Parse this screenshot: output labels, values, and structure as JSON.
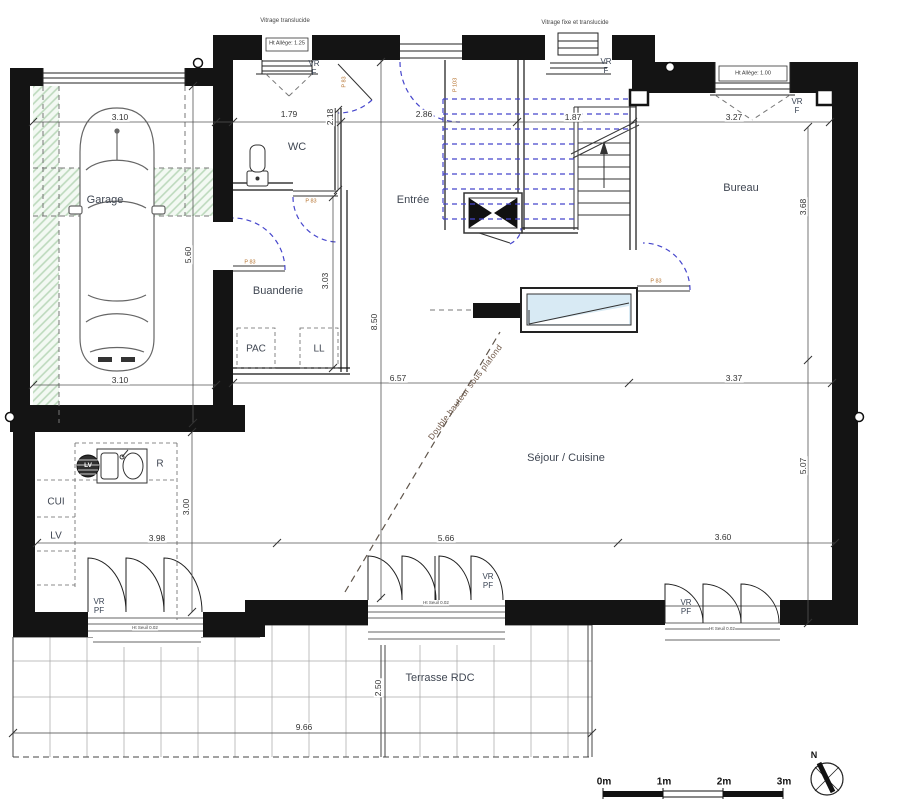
{
  "rooms": {
    "garage": "Garage",
    "wc": "WC",
    "entree": "Entrée",
    "bureau": "Bureau",
    "buanderie": "Buanderie",
    "pac": "PAC",
    "ll": "LL",
    "sejour": "Séjour / Cuisine",
    "cui": "CUI",
    "lv": "LV",
    "lv_appliance": "LV",
    "fridge": "R",
    "terrasse": "Terrasse RDC"
  },
  "dims": {
    "garage_w": "3.10",
    "garage_w2": "3.10",
    "garage_d": "5.60",
    "wc_w": "1.79",
    "wc_d": "2.18",
    "entree_w": "2.86",
    "stair_w": "1.87",
    "bureau_w": "3.27",
    "bureau_d": "3.68",
    "sejour_top_w": "6.57",
    "bureau_bottom_w": "3.37",
    "kitchen_w": "3.98",
    "sejour_w": "5.66",
    "sejour_right_w": "3.60",
    "sejour_d": "5.07",
    "kitchen_d": "3.00",
    "buanderie_d": "3.03",
    "entree_d": "8.50",
    "terrasse_w": "9.66",
    "terrasse_d": "2.50"
  },
  "windows": {
    "vitrage_translucide": "Vitrage translucide",
    "vitrage_fixe": "Vitrage fixe et translucide",
    "allege_125": "Ht Allège: 1.25",
    "allege_100": "Ht Allège: 1.00",
    "vr_f": "VR F",
    "vr_pf": "VR PF",
    "seuil": "Ht Seuil 0.02"
  },
  "doors": {
    "p83": "P 83",
    "p103": "P 103"
  },
  "notes": {
    "double_height": "Double hauteur sous plafond"
  },
  "scale_bar": {
    "m0": "0m",
    "m1": "1m",
    "m2": "2m",
    "m3": "3m"
  },
  "compass": {
    "north": "N"
  },
  "colors": {
    "hatch_green": "#bcd9bc",
    "glass_blue": "#d8eaf4",
    "door_arc_blue": "#4646cc",
    "door_label_orange": "#b5722e"
  }
}
